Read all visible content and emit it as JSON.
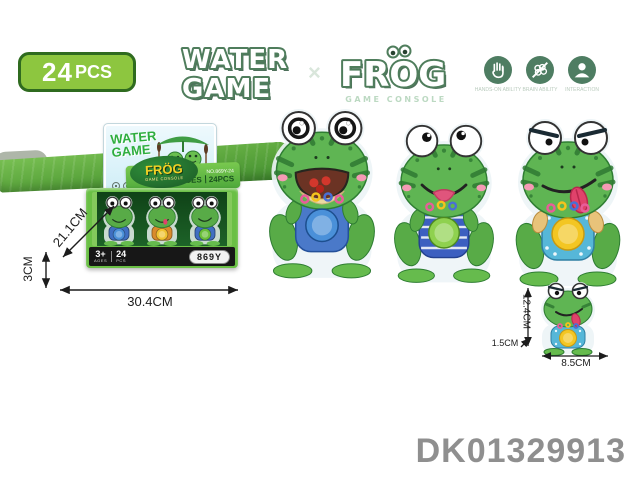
{
  "badge": {
    "count": "24",
    "unit": "PCS"
  },
  "logo": {
    "water": "WATER",
    "game": "GAME",
    "separator": "×",
    "brand": "FROG",
    "brand_sub": "GAME CONSOLE"
  },
  "feature_icons": {
    "items": [
      {
        "caption": "HANDS-ON ABILITY"
      },
      {
        "caption": "BRAIN ABILITY"
      },
      {
        "caption": "INTERACTION"
      }
    ]
  },
  "box": {
    "card_title_1": "WATER",
    "card_title_2": "GAME",
    "pad_brand": "FRÖG",
    "pad_sub": "GAME CONSOLE",
    "band_no": "NO.869Y-24",
    "band_ages": "3+AGES",
    "band_pcs": "24PCS",
    "strip_age": "3+",
    "strip_age_sub": "AGES",
    "strip_count": "24",
    "strip_count_sub": "PCS",
    "strip_code": "869Y"
  },
  "measurements": {
    "box_height": "21.1CM",
    "box_depth": "3CM",
    "box_width": "30.4CM",
    "item_height": "12.4CM",
    "item_depth": "1.5CM",
    "item_width": "8.5CM"
  },
  "display_frogs": [
    {
      "button": "#4a90d9",
      "body": "#3f6fc2"
    },
    {
      "button": "#f0c332",
      "body": "#d98b2b"
    },
    {
      "button": "#6abf3a",
      "body": "#3f6fc2"
    }
  ],
  "large_frogs": [
    {
      "button": "#4a90d9",
      "body": "#4a79c9"
    },
    {
      "button": "#8fd14f",
      "body": "#3c5fc0"
    },
    {
      "button": "#f3c623",
      "body": "#56b7d8"
    }
  ],
  "small_frog": {
    "button": "#f3c623",
    "body": "#56b7d8"
  },
  "product_code": "DK01329913",
  "colors": {
    "badge_green": "#8dc63f",
    "badge_border": "#2f6b1f",
    "logo_outline": "#4f7d5c",
    "icon_circle": "#4e7d62",
    "box_green": "#6abf45",
    "strip_black": "#171717",
    "frog_green": "#5fb553",
    "code_gray": "#8f8f8f"
  }
}
